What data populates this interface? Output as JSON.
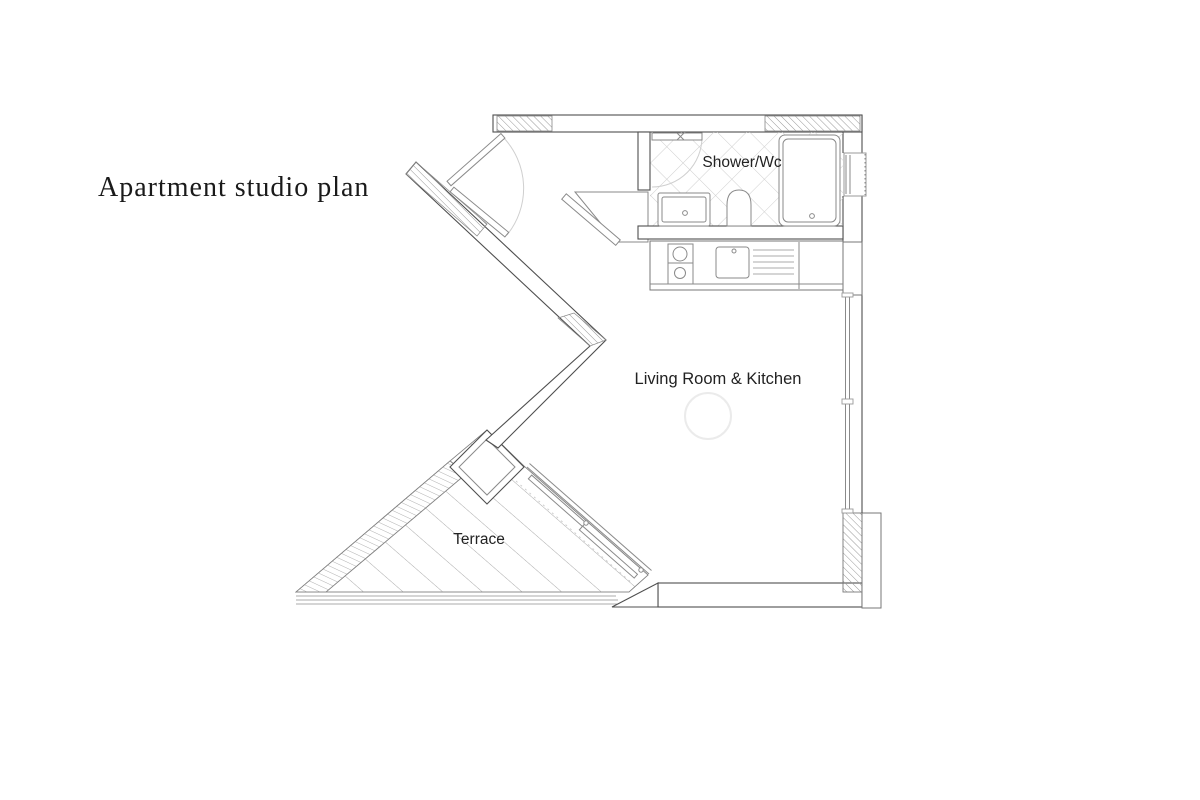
{
  "title": "Apartment studio plan",
  "rooms": {
    "bathroom": "Shower/Wc",
    "living": "Living Room & Kitchen",
    "terrace": "Terrace"
  },
  "colors": {
    "bg": "#ffffff",
    "wall": "#4f4f4f",
    "fixture": "#8a8a8a",
    "hatch": "#989898",
    "tile": "#cfcfcf",
    "deck": "#ababab",
    "faint": "#cfcfcf",
    "text": "#222222",
    "titletext": "#1a1a1a"
  }
}
